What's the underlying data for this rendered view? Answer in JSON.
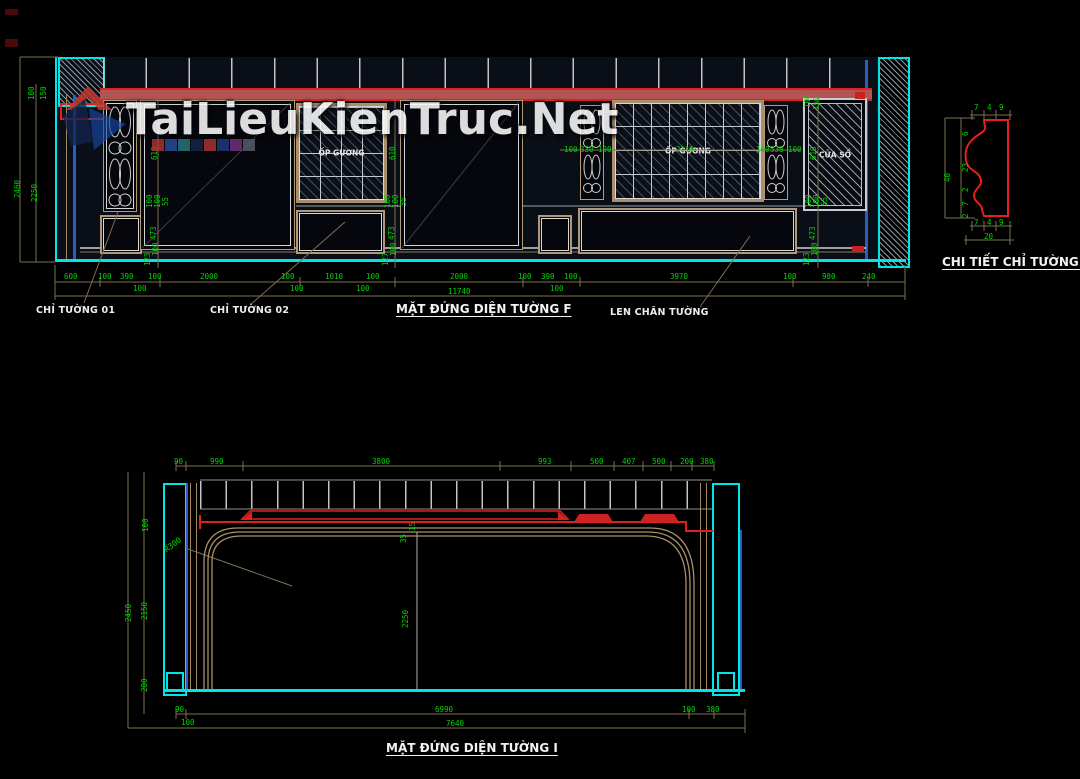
{
  "watermark": {
    "text": "TaiLieuKienTruc.Net"
  },
  "palette_squares": [
    "#b13434",
    "#2b4fa0",
    "#2b7d7d",
    "#15264c",
    "#b13434",
    "#1d3c86",
    "#7c2f86",
    "#596070"
  ],
  "colors": {
    "dim_green": "#00d400",
    "cad_cyan": "#00e5e5",
    "cad_red": "#e02020",
    "cad_tan": "#b39a76",
    "cad_blue": "#2a5ec4",
    "cad_line": "#c8c8c8"
  },
  "top_view": {
    "title": "MẶT ĐỨNG DIỆN TƯỜNG F",
    "panel_labels": {
      "op_guong_left": "ỐP GƯƠNG",
      "op_guong_right": "ỐP GƯƠNG",
      "cua_so": "CỬA SỔ"
    },
    "callouts": {
      "chi_tuong_01": "CHỈ TƯỜNG 01",
      "chi_tuong_02": "CHỈ TƯỜNG 02",
      "len_chan_tuong": "LEN CHÂN TƯỜNG"
    },
    "overall_width": "11740",
    "overall_height": "2460",
    "wall_height": "2250"
  },
  "detail_view": {
    "title": "CHI TIẾT CHỈ TƯỜNG 02",
    "overall_height": "40",
    "overall_width": "20"
  },
  "bottom_view": {
    "title": "MẶT ĐỨNG DIỆN TƯỜNG I",
    "radius": "R300",
    "overall_width": "7640",
    "overall_height": "2450"
  },
  "labels": [
    {
      "text": "600",
      "x": 64,
      "y": 273,
      "cls": "dim"
    },
    {
      "text": "100",
      "x": 98,
      "y": 273,
      "cls": "dim"
    },
    {
      "text": "390",
      "x": 120,
      "y": 273,
      "cls": "dim"
    },
    {
      "text": "100",
      "x": 148,
      "y": 273,
      "cls": "dim"
    },
    {
      "text": "100",
      "x": 133,
      "y": 285,
      "cls": "dim"
    },
    {
      "text": "2000",
      "x": 200,
      "y": 273,
      "cls": "dim"
    },
    {
      "text": "100",
      "x": 281,
      "y": 273,
      "cls": "dim"
    },
    {
      "text": "100",
      "x": 290,
      "y": 285,
      "cls": "dim"
    },
    {
      "text": "1010",
      "x": 325,
      "y": 273,
      "cls": "dim"
    },
    {
      "text": "100",
      "x": 366,
      "y": 273,
      "cls": "dim"
    },
    {
      "text": "100",
      "x": 356,
      "y": 285,
      "cls": "dim"
    },
    {
      "text": "2000",
      "x": 450,
      "y": 273,
      "cls": "dim"
    },
    {
      "text": "100",
      "x": 518,
      "y": 273,
      "cls": "dim"
    },
    {
      "text": "390",
      "x": 541,
      "y": 273,
      "cls": "dim"
    },
    {
      "text": "100",
      "x": 564,
      "y": 273,
      "cls": "dim"
    },
    {
      "text": "100",
      "x": 550,
      "y": 285,
      "cls": "dim"
    },
    {
      "text": "3970",
      "x": 670,
      "y": 273,
      "cls": "dim"
    },
    {
      "text": "100",
      "x": 783,
      "y": 273,
      "cls": "dim"
    },
    {
      "text": "980",
      "x": 822,
      "y": 273,
      "cls": "dim"
    },
    {
      "text": "240",
      "x": 862,
      "y": 273,
      "cls": "dim"
    },
    {
      "text": "11740",
      "x": 448,
      "y": 288,
      "cls": "dim"
    },
    {
      "text": "100",
      "x": 28,
      "y": 100,
      "cls": "dimr"
    },
    {
      "text": "150",
      "x": 40,
      "y": 100,
      "cls": "dimr"
    },
    {
      "text": "2460",
      "x": 14,
      "y": 198,
      "cls": "dimr"
    },
    {
      "text": "2250",
      "x": 31,
      "y": 202,
      "cls": "dimr"
    },
    {
      "text": "610",
      "x": 151,
      "y": 160,
      "cls": "dimr"
    },
    {
      "text": "100",
      "x": 146,
      "y": 208,
      "cls": "dimr"
    },
    {
      "text": "100",
      "x": 154,
      "y": 208,
      "cls": "dimr"
    },
    {
      "text": "55",
      "x": 162,
      "y": 206,
      "cls": "dimr"
    },
    {
      "text": "473",
      "x": 150,
      "y": 240,
      "cls": "dimr"
    },
    {
      "text": "100",
      "x": 152,
      "y": 256,
      "cls": "dimr"
    },
    {
      "text": "123",
      "x": 144,
      "y": 266,
      "cls": "dimr"
    },
    {
      "text": "610",
      "x": 389,
      "y": 160,
      "cls": "dimr"
    },
    {
      "text": "100",
      "x": 384,
      "y": 208,
      "cls": "dimr"
    },
    {
      "text": "100",
      "x": 392,
      "y": 208,
      "cls": "dimr"
    },
    {
      "text": "55",
      "x": 400,
      "y": 206,
      "cls": "dimr"
    },
    {
      "text": "473",
      "x": 388,
      "y": 240,
      "cls": "dimr"
    },
    {
      "text": "100",
      "x": 390,
      "y": 256,
      "cls": "dimr"
    },
    {
      "text": "127",
      "x": 382,
      "y": 266,
      "cls": "dimr"
    },
    {
      "text": "100",
      "x": 804,
      "y": 108,
      "cls": "dimr"
    },
    {
      "text": "150",
      "x": 813,
      "y": 110,
      "cls": "dimr"
    },
    {
      "text": "610",
      "x": 810,
      "y": 160,
      "cls": "dimr"
    },
    {
      "text": "100",
      "x": 805,
      "y": 208,
      "cls": "dimr"
    },
    {
      "text": "100",
      "x": 813,
      "y": 208,
      "cls": "dimr"
    },
    {
      "text": "55",
      "x": 821,
      "y": 206,
      "cls": "dimr"
    },
    {
      "text": "473",
      "x": 809,
      "y": 240,
      "cls": "dimr"
    },
    {
      "text": "100",
      "x": 811,
      "y": 256,
      "cls": "dimr"
    },
    {
      "text": "123",
      "x": 803,
      "y": 266,
      "cls": "dimr"
    },
    {
      "text": "100",
      "x": 564,
      "y": 146,
      "cls": "dim"
    },
    {
      "text": "330",
      "x": 580,
      "y": 146,
      "cls": "dim"
    },
    {
      "text": "100",
      "x": 598,
      "y": 146,
      "cls": "dim"
    },
    {
      "text": "2110",
      "x": 676,
      "y": 146,
      "cls": "dim"
    },
    {
      "text": "100",
      "x": 756,
      "y": 146,
      "cls": "dim"
    },
    {
      "text": "330",
      "x": 770,
      "y": 146,
      "cls": "dim"
    },
    {
      "text": "100",
      "x": 788,
      "y": 146,
      "cls": "dim"
    },
    {
      "text": "7",
      "x": 974,
      "y": 104,
      "cls": "dim"
    },
    {
      "text": "4",
      "x": 987,
      "y": 104,
      "cls": "dim"
    },
    {
      "text": "9",
      "x": 999,
      "y": 104,
      "cls": "dim"
    },
    {
      "text": "40",
      "x": 944,
      "y": 182,
      "cls": "dimr"
    },
    {
      "text": "6",
      "x": 962,
      "y": 136,
      "cls": "dimr"
    },
    {
      "text": "23",
      "x": 962,
      "y": 172,
      "cls": "dimr"
    },
    {
      "text": "2",
      "x": 962,
      "y": 192,
      "cls": "dimr"
    },
    {
      "text": "7",
      "x": 962,
      "y": 206,
      "cls": "dimr"
    },
    {
      "text": "2",
      "x": 962,
      "y": 218,
      "cls": "dimr"
    },
    {
      "text": "7",
      "x": 974,
      "y": 219,
      "cls": "dim"
    },
    {
      "text": "4",
      "x": 987,
      "y": 219,
      "cls": "dim"
    },
    {
      "text": "9",
      "x": 999,
      "y": 219,
      "cls": "dim"
    },
    {
      "text": "20",
      "x": 984,
      "y": 233,
      "cls": "dim"
    },
    {
      "text": "90",
      "x": 174,
      "y": 458,
      "cls": "dim"
    },
    {
      "text": "990",
      "x": 210,
      "y": 458,
      "cls": "dim"
    },
    {
      "text": "3800",
      "x": 372,
      "y": 458,
      "cls": "dim"
    },
    {
      "text": "993",
      "x": 538,
      "y": 458,
      "cls": "dim"
    },
    {
      "text": "500",
      "x": 590,
      "y": 458,
      "cls": "dim"
    },
    {
      "text": "407",
      "x": 622,
      "y": 458,
      "cls": "dim"
    },
    {
      "text": "500",
      "x": 652,
      "y": 458,
      "cls": "dim"
    },
    {
      "text": "200",
      "x": 680,
      "y": 458,
      "cls": "dim"
    },
    {
      "text": "380",
      "x": 700,
      "y": 458,
      "cls": "dim"
    },
    {
      "text": "100",
      "x": 142,
      "y": 532,
      "cls": "dimr"
    },
    {
      "text": "2150",
      "x": 141,
      "y": 620,
      "cls": "dimr"
    },
    {
      "text": "200",
      "x": 141,
      "y": 692,
      "cls": "dimr"
    },
    {
      "text": "2450",
      "x": 125,
      "y": 622,
      "cls": "dimr"
    },
    {
      "text": "15",
      "x": 409,
      "y": 531,
      "cls": "dimr"
    },
    {
      "text": "35",
      "x": 400,
      "y": 543,
      "cls": "dimr"
    },
    {
      "text": "2250",
      "x": 402,
      "y": 628,
      "cls": "dimr"
    },
    {
      "text": "R300",
      "x": 163,
      "y": 548,
      "cls": "r300"
    },
    {
      "text": "90",
      "x": 175,
      "y": 706,
      "cls": "dim"
    },
    {
      "text": "100",
      "x": 181,
      "y": 719,
      "cls": "dim"
    },
    {
      "text": "6990",
      "x": 435,
      "y": 706,
      "cls": "dim"
    },
    {
      "text": "100",
      "x": 682,
      "y": 706,
      "cls": "dim"
    },
    {
      "text": "380",
      "x": 706,
      "y": 706,
      "cls": "dim"
    },
    {
      "text": "7640",
      "x": 446,
      "y": 720,
      "cls": "dim"
    }
  ]
}
